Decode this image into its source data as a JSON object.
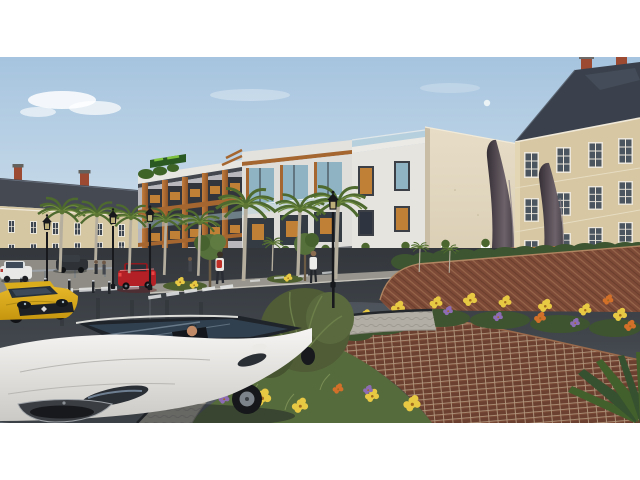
{
  "scene": {
    "description": "3D architectural rendering of a modern apartment complex beside classic European buildings, with a two-tier brick roundabout planted with flowers, a dark teardrop sculpture pair, wet asphalt streets, palm-lined median, cars and pedestrians",
    "sky": {
      "moon_visible": true,
      "clouds": "sparse white clouds left"
    },
    "buildings": [
      {
        "name": "classic-building-left",
        "style": "classical facade, slate roof, brick chimneys"
      },
      {
        "name": "modern-apartment-complex",
        "style": "white contemporary block, wood accent pillars, glass balconies, rooftop green sign (text illegible)"
      },
      {
        "name": "blank-side-wall",
        "style": "plain cream concrete side wall"
      },
      {
        "name": "classic-building-right",
        "style": "mansard slate roof, red brick chimneys, tall white windows"
      }
    ],
    "roundabout": {
      "walls": "two tiers of curved brick retaining walls",
      "planting": "yellow, orange and purple flower clusters with shrubs and grasses",
      "sculpture": "two dark teardrop-shaped spires"
    },
    "vehicles": [
      {
        "name": "white-sedan",
        "position": "foreground left, driver visible"
      },
      {
        "name": "yellow-hatchback",
        "position": "left edge"
      },
      {
        "name": "red-hatchback",
        "position": "middle street"
      },
      {
        "name": "white-compact",
        "position": "background far left"
      },
      {
        "name": "dark-sedan",
        "position": "background left"
      }
    ],
    "pedestrians": 5,
    "street": {
      "surface": "wet asphalt with reflections",
      "features": [
        "dashed road markings",
        "cobblestone ring around roundabout",
        "palm-lined median with rail and bollards",
        "black street lamps",
        "white fence with orange cap and planter boxes"
      ]
    }
  },
  "palette": {
    "letterbox": "#ffffff",
    "sky_top": "#a6c4df",
    "sky_low": "#e4edf1",
    "cloud": "#ffffff",
    "moon": "#eef4f8",
    "classic_roof": "#454a52",
    "classic_facade": "#d6c7a3",
    "chimney_brick": "#9c4a32",
    "modern_facade": "#e4e2dd",
    "modern_gray": "#b9b9bd",
    "wood_accent": "#c37d3e",
    "window_amber": "#c08035",
    "window_glass": "#8fb3c2",
    "window_dark": "#343b43",
    "cream_wall": "#e7ddc7",
    "mansard_facade": "#d7c7a2",
    "mansard_roof": "#3a414c",
    "sculpture_dark": "#352f35",
    "sculpture_light": "#6d6269",
    "hedge": "#3d5530",
    "bush": "#4f5c36",
    "grass": "#566b3c",
    "brick_upper": "#7c4a36",
    "brick_lower": "#6b4030",
    "flower_yellow": "#e8c944",
    "flower_orange": "#d2702a",
    "flower_purple": "#8d6cb4",
    "paver": "#b2aea5",
    "sidewalk": "#97958d",
    "median": "#8e8c84",
    "road_dark": "#33373c",
    "road_light": "#5a6168",
    "marking_white": "#e8eaea",
    "fence_white": "#f3f1ea",
    "fence_band": "#c87f3c",
    "car_white": "#f5f4f2",
    "car_yellow": "#e9bb2a",
    "car_red": "#b32025",
    "car_dark": "#2e3237",
    "car_compact": "#e9eae8",
    "lamp_black": "#17191c",
    "palm_frond": "#4e6a2e",
    "sign_green": "#2a5a22"
  }
}
